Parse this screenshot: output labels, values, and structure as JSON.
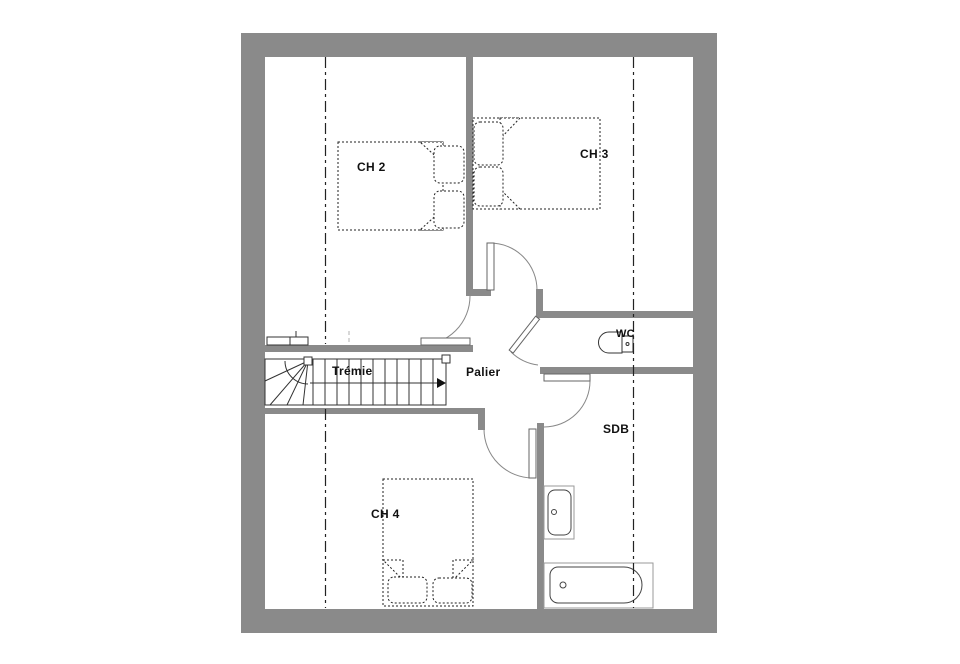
{
  "plan": {
    "type": "floor-plan",
    "floor": "upper",
    "rooms": {
      "ch2": {
        "label": "CH 2"
      },
      "ch3": {
        "label": "CH 3"
      },
      "ch4": {
        "label": "CH 4"
      },
      "tremie": {
        "label": "Trémie"
      },
      "palier": {
        "label": "Palier"
      },
      "wc": {
        "label": "WC"
      },
      "sdb": {
        "label": "SDB"
      }
    },
    "fixtures": [
      "double-bed-ch2",
      "double-bed-ch3",
      "double-bed-ch4",
      "staircase-with-winder",
      "toilet",
      "washbasin",
      "bathtub"
    ],
    "colors": {
      "wall": "#8a8a8a",
      "line": "#2a2a2a",
      "fixture_outline": "#999999",
      "background": "#ffffff"
    }
  }
}
